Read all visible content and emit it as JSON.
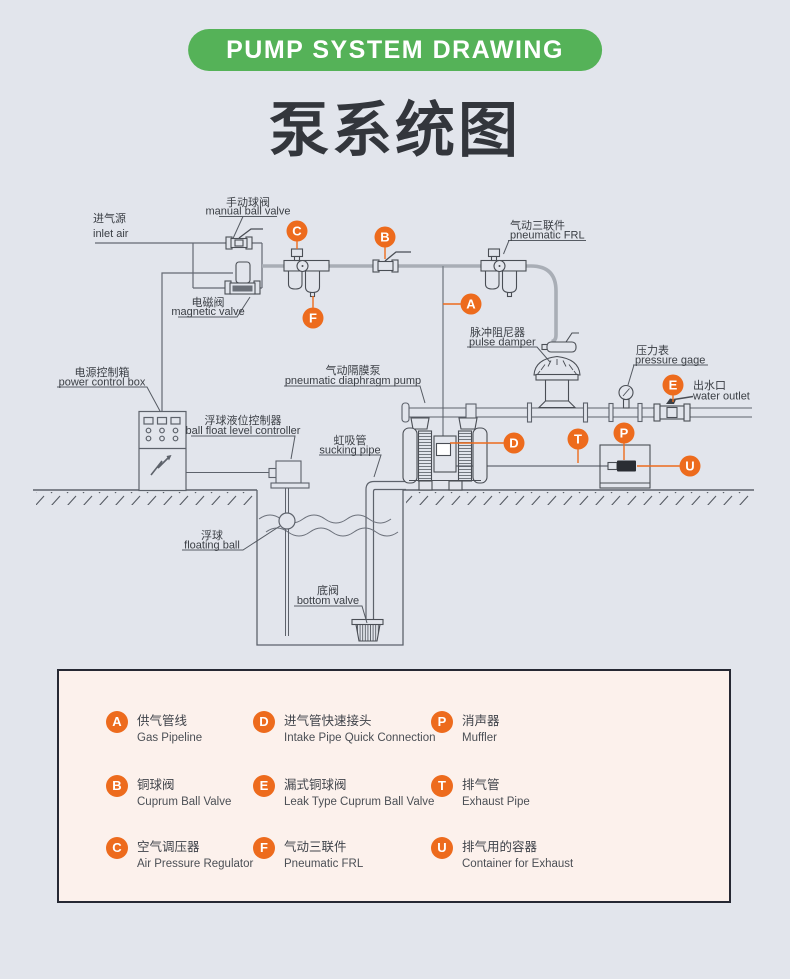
{
  "banner": {
    "text": "PUMP SYSTEM DRAWING"
  },
  "title": {
    "zh": "泵系统图"
  },
  "colors": {
    "background": "#e2e5ec",
    "banner_green": "#55b258",
    "accent_orange": "#ed6b1d",
    "line_dark": "#5d626b",
    "pipe_gray": "#a9aeb6",
    "legend_bg": "#fcf1ec"
  },
  "diagram": {
    "labels": {
      "inlet_air": {
        "zh": "进气源",
        "en": "inlet air"
      },
      "manual_ball_valve": {
        "zh": "手动球阀",
        "en": "manual ball valve"
      },
      "magnetic_valve": {
        "zh": "电磁阀",
        "en": "magnetic valve"
      },
      "pneumatic_frl": {
        "zh": "气动三联件",
        "en": "pneumatic FRL"
      },
      "pulse_damper": {
        "zh": "脉冲阻尼器",
        "en": "pulse damper"
      },
      "pressure_gage": {
        "zh": "压力表",
        "en": "pressure gage"
      },
      "water_outlet": {
        "zh": "出水口",
        "en": "water outlet"
      },
      "power_control_box": {
        "zh": "电源控制箱",
        "en": "power control box"
      },
      "ball_float_level_controller": {
        "zh": "浮球液位控制器",
        "en": "ball float level controller"
      },
      "pneumatic_diaphragm_pump": {
        "zh": "气动隔膜泵",
        "en": "pneumatic diaphragm pump"
      },
      "sucking_pipe": {
        "zh": "虹吸管",
        "en": "sucking pipe"
      },
      "floating_ball": {
        "zh": "浮球",
        "en": "floating ball"
      },
      "bottom_valve": {
        "zh": "底阀",
        "en": "bottom valve"
      }
    },
    "markers": {
      "a": "A",
      "b": "B",
      "c": "C",
      "d": "D",
      "e": "E",
      "f": "F",
      "p": "P",
      "t": "T",
      "u": "U"
    }
  },
  "legend": {
    "items": [
      {
        "letter": "A",
        "zh": "供气管线",
        "en": "Gas Pipeline"
      },
      {
        "letter": "D",
        "zh": "进气管快速接头",
        "en": "Intake Pipe Quick Connection"
      },
      {
        "letter": "P",
        "zh": "消声器",
        "en": "Muffler"
      },
      {
        "letter": "B",
        "zh": "铜球阀",
        "en": "Cuprum Ball Valve"
      },
      {
        "letter": "E",
        "zh": "漏式铜球阀",
        "en": "Leak Type Cuprum Ball Valve"
      },
      {
        "letter": "T",
        "zh": "排气管",
        "en": "Exhaust Pipe"
      },
      {
        "letter": "C",
        "zh": "空气调压器",
        "en": "Air Pressure Regulator"
      },
      {
        "letter": "F",
        "zh": "气动三联件",
        "en": "Pneumatic FRL"
      },
      {
        "letter": "U",
        "zh": "排气用的容器",
        "en": "Container for Exhaust"
      }
    ]
  }
}
